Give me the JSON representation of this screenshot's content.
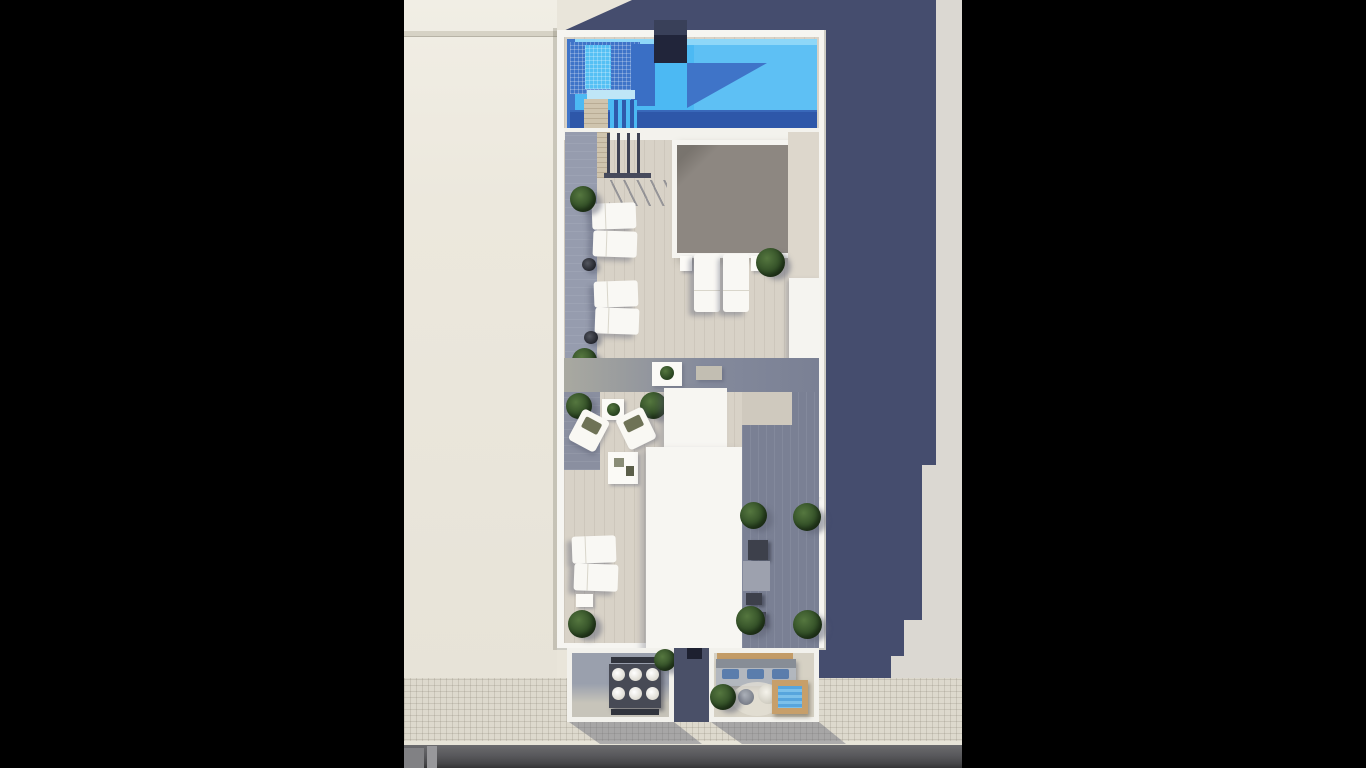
{
  "scene": {
    "medium": "3d-architectural-render",
    "view": "top-down aerial",
    "description": "Letterboxed aerial 3D rendering of a narrow rooftop terrace: a bright blue swimming pool with tanning ledge at top, a gray courtyard skylight, rows of white sun loungers and potted plants on travertine decking, a lounge corner with armchairs, white roof-access cores, shaded decking with AC units, and two street-facing balconies (outdoor dining for six, sofa with wooden plunge tub) above a tiled sidewalk and asphalt street; a large navy shadow is cast to the right over a neighboring lot.",
    "letterbox_color": "#000000",
    "photo": {
      "width_px": 558,
      "height_px": 768,
      "offset_left_px": 404
    }
  },
  "palette": {
    "letterbox": "#000000",
    "pool_water_bright": "#4cb9f3",
    "pool_water_shadow": "#3f74c8",
    "pool_water_deep": "#2e57a9",
    "pool_ledge": "#6ac6f5",
    "shadow_navy": "#454d6e",
    "neighbor_roof_beige": "#eae6db",
    "deck_travertine": "#d8d2c7",
    "deck_shaded_gray": "#7a8094",
    "walkway_gray": "#969cae",
    "skylight_gray": "#8d8781",
    "structure_white": "#f6f5f1",
    "wood_tan": "#c39c67",
    "foliage_green": "#2e4a24",
    "cushion_blue": "#5a7dac",
    "sidewalk_tile": "#ddd9cd",
    "road_asphalt": "#59595c"
  },
  "counts": {
    "sun_loungers_upper_left": 4,
    "sun_loungers_center": 2,
    "sun_loungers_lower_left": 2,
    "dining_places": 6,
    "sofa_cushions": 3,
    "potted_plants": 14
  },
  "objects": {
    "photo": "Aerial 3D rendering of a rooftop pool terrace",
    "neighbor": "Adjacent building rooftop",
    "ground": "Neighboring lot ground",
    "shadow": "Building shadow cast over neighboring lot",
    "building": "Rooftop terrace of narrow residential building",
    "pool": "Swimming pool",
    "ledge": "Tanning ledge with tiled steps",
    "monolith": "Pool feature wall",
    "stairs": "Pool deck stairs with railing",
    "skylight": "Skylight over courtyard",
    "sunbed": "Sun lounger",
    "pot": "Planter pot",
    "plant": "Potted plant",
    "side_table": "Side table",
    "slab": "Privacy wall",
    "mid_table": "Deck table",
    "bench": "Deck bench",
    "lounge_chair": "Lounge armchair",
    "coffee_table": "Coffee table with decor",
    "core": "Roof access core",
    "ac": "Rooftop AC unit",
    "balcony_left": "Balcony with outdoor dining set",
    "dining_table": "Dining table for six",
    "balcony_gap": "Recessed facade between balconies",
    "balcony_right": "Balcony lounge with sofa",
    "pergola": "Wooden pergola beam",
    "sofa": "Balcony sofa with blue cushions",
    "rug": "Round outdoor rug",
    "pouf": "Outdoor pouf",
    "plunge": "Wooden plunge tub",
    "sidewalk": "Tiled sidewalk",
    "road": "Asphalt street",
    "crosswalk": "Curb ramp markings"
  }
}
